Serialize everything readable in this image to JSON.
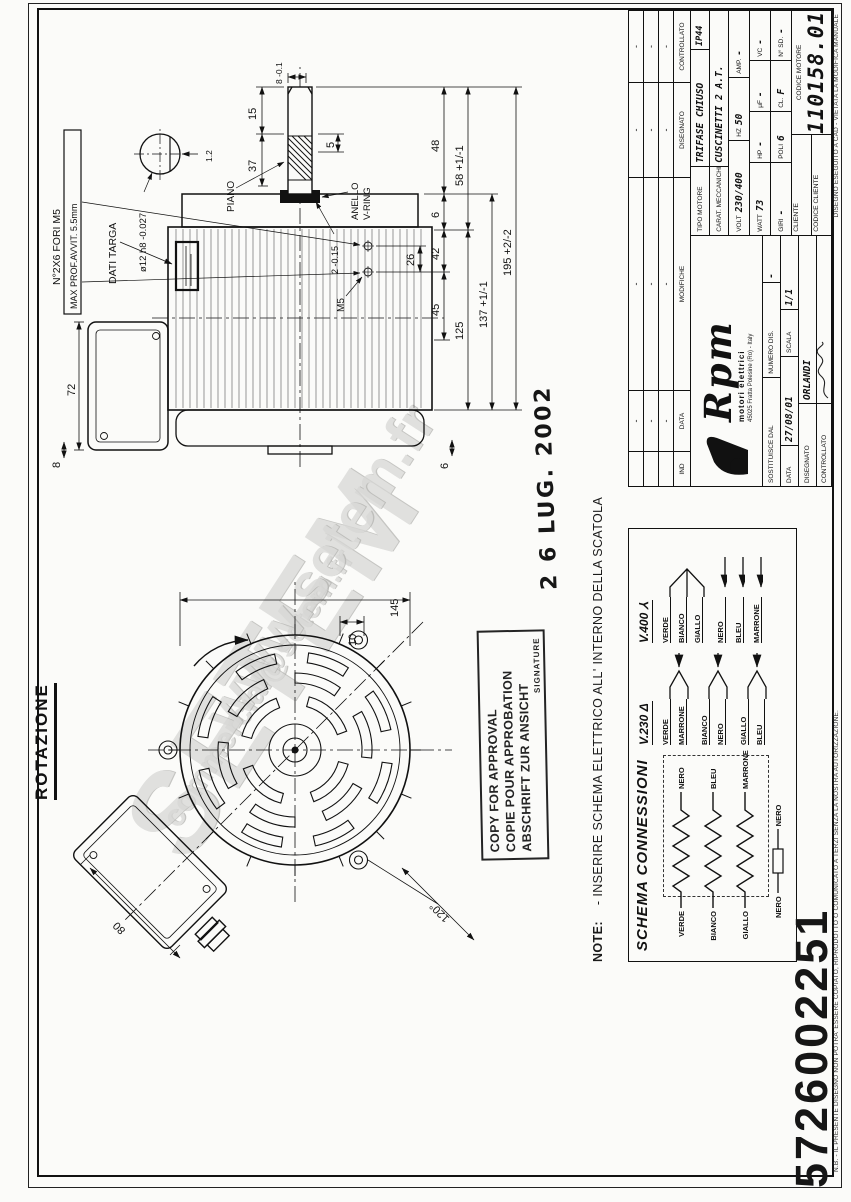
{
  "page": {
    "serial_stamp": "5726002251"
  },
  "watermark": {
    "big": "SETEM",
    "url": "www.setem.fr",
    "mail": "commercial@setem.fr"
  },
  "rotation_label": "ROTAZIONE",
  "note": {
    "label": "NOTE:",
    "text": "- INSERIRE SCHEMA ELETTRICO ALL' INTERNO DELLA SCATOLA"
  },
  "date_stamp": "2 6 LUG. 2002",
  "approval_stamp": {
    "line1": "COPY FOR APPROVAL",
    "line2": "COPIE POUR APPROBATION",
    "line3": "ABSCHRIFT ZUR ANSICHT",
    "line4": "SIGNATURE"
  },
  "drawing": {
    "side": {
      "d72": "72",
      "d8": "8",
      "d6b": "6",
      "fori1": "N°2X6 FORI M5",
      "fori2": "MAX PROF.AVVIT. 5.5mm",
      "dati_targa": "DATI TARGA",
      "m5": "M5",
      "piano": "PIANO",
      "d37": "37",
      "d15": "15",
      "d5": "5",
      "d12": "ø12 h8 -0.027",
      "d12b": "1.2",
      "d8b": "8 -0.1",
      "d2": "2 -0.15",
      "anello1": "ANELLO",
      "anello2": "V-RING",
      "d26": "26",
      "d45": "45",
      "d42": "42",
      "d6a": "6",
      "d48": "48",
      "d125": "125",
      "d58": "58 +1/-1",
      "d137": "137 +1/-1",
      "d195": "195 +2/-2"
    },
    "front": {
      "d80": "80",
      "d120": "120°",
      "d145": "145",
      "d10": "10"
    }
  },
  "schema": {
    "title": "SCHEMA CONNESSIONI",
    "windings": [
      {
        "left": "VERDE",
        "right": "NERO"
      },
      {
        "left": "BIANCO",
        "right": "BLEU"
      },
      {
        "left": "GIALLO",
        "right": "MARRONE"
      }
    ],
    "protector": {
      "left": "NERO",
      "right": "NERO"
    },
    "v230": {
      "label": "V.230 Δ",
      "pairs": [
        {
          "a": "VERDE",
          "b": "MARRONE"
        },
        {
          "a": "BIANCO",
          "b": "NERO"
        },
        {
          "a": "GIALLO",
          "b": "BLEU"
        }
      ]
    },
    "v400": {
      "label": "V.400 ⅄",
      "star": [
        "VERDE",
        "BIANCO",
        "GIALLO"
      ],
      "lines": [
        "NERO",
        "BLEU",
        "MARRONE"
      ]
    }
  },
  "titleblock": {
    "revisions": {
      "headers": {
        "ind": "IND",
        "data": "DATA",
        "modifiche": "MODIFICHE",
        "disegnato": "DISEGNATO",
        "controllato": "CONTROLLATO"
      },
      "rows": [
        [
          "",
          "-",
          "-",
          "-",
          "-"
        ],
        [
          "",
          "-",
          "-",
          "-",
          "-"
        ],
        [
          "",
          "-",
          "-",
          "-",
          "-"
        ]
      ]
    },
    "logo": {
      "name": "Rpm",
      "tagline": "motori elettrici",
      "address": "45025 Fratta Polesine (Ro) - Italy"
    },
    "sostituisce": {
      "label": "SOSTITUISCE DAL",
      "label2": "NUMERO DIS.",
      "value": "-"
    },
    "data": {
      "label": "DATA",
      "value": "27/08/01"
    },
    "scala": {
      "label": "SCALA",
      "value": "1/1"
    },
    "disegnato": {
      "label": "DISEGNATO",
      "value": "ORLANDI"
    },
    "controllato": {
      "label": "CONTROLLATO"
    },
    "tipo": {
      "label": "TIPO MOTORE",
      "value": "TRIFASE CHIUSO",
      "ip": "IP44"
    },
    "carat": {
      "label": "CARAT. MECCANICHE",
      "value": "CUSCINETTI 2 A.T."
    },
    "row_volt": [
      {
        "l": "VOLT",
        "v": "230/400"
      },
      {
        "l": "HZ",
        "v": "50"
      },
      {
        "l": "AMP.",
        "v": "-"
      }
    ],
    "row_watt": [
      {
        "l": "WATT",
        "v": "73"
      },
      {
        "l": "HP",
        "v": "-"
      },
      {
        "l": "μF",
        "v": "-"
      },
      {
        "l": "VC",
        "v": "-"
      }
    ],
    "row_giri": [
      {
        "l": "GIRI",
        "v": "-"
      },
      {
        "l": "POLI",
        "v": "6"
      },
      {
        "l": "CL.",
        "v": "F"
      },
      {
        "l": "N° SD.",
        "v": "-"
      }
    ],
    "cliente": "CLIENTE",
    "codice_cliente": "CODICE CLIENTE",
    "codice_motore": {
      "label": "CODICE MOTORE",
      "value": "110158.01"
    }
  },
  "legal": {
    "left": "N.B. - IL PRESENTE DISEGNO NON POTRA' ESSERE COPIATO, RIPRODOTTO O COMUNICATO A TERZI SENZA LA NOSTRA AUTORIZZAZIONE.",
    "right": "DISEGNO ESEGUITO A CAD - VIETATA LA MODIFICA MANUALE"
  }
}
